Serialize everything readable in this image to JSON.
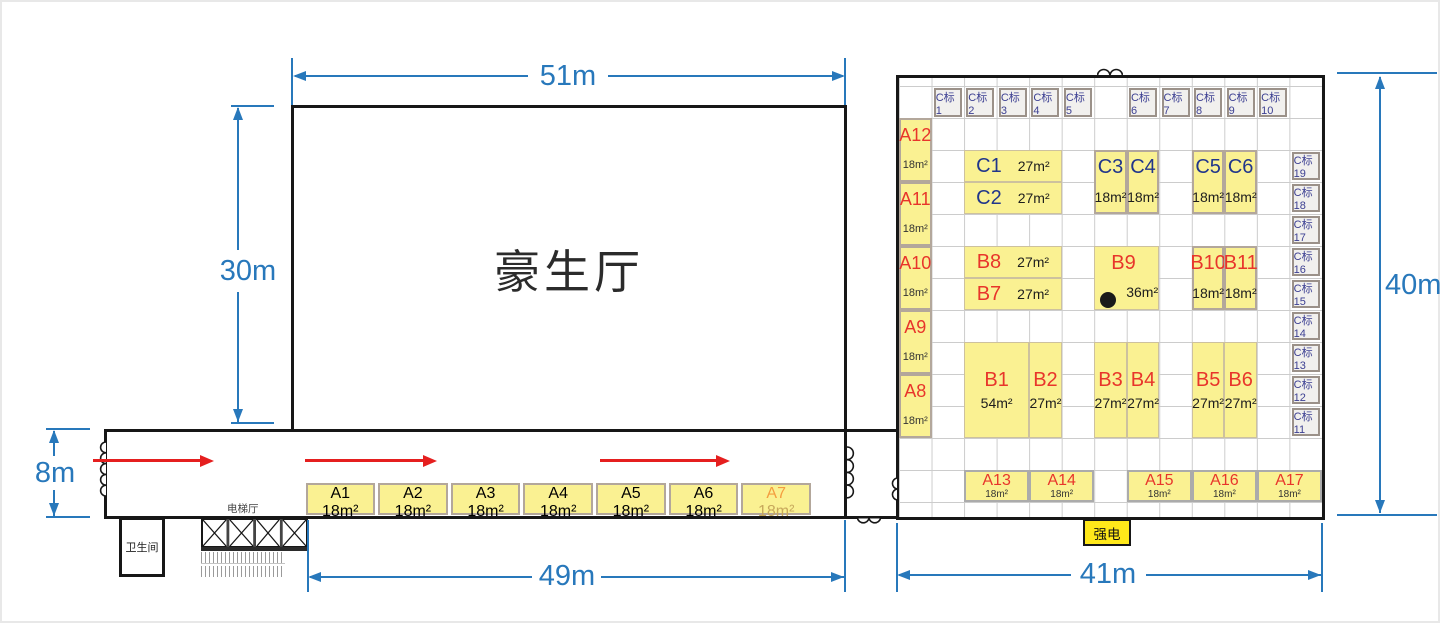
{
  "hall": {
    "name": "豪生厅"
  },
  "labels": {
    "restroom": "卫生间",
    "elevator_hall": "电梯厅",
    "power": "强电"
  },
  "dimensions": {
    "hall_width": "51m",
    "hall_height": "30m",
    "corridor_height": "8m",
    "corridor_width": "49m",
    "right_width": "41m",
    "right_height": "40m"
  },
  "colors": {
    "dimension_blue": "#2878BB",
    "arrow_red": "#E51F1F",
    "booth_yellow": "#FAF192",
    "booth_label_red": "#E8352B",
    "booth_label_blue": "#21368B",
    "stand_gray": "#F1F0EE",
    "stand_text": "#3C3F92",
    "power_yellow": "#FFE81A",
    "muted_orange": "#F49D3F",
    "wall_black": "#171717"
  },
  "corridor": {
    "booths": [
      {
        "id": "A1",
        "label": "A1",
        "area": "18m²"
      },
      {
        "id": "A2",
        "label": "A2",
        "area": "18m²"
      },
      {
        "id": "A3",
        "label": "A3",
        "area": "18m²"
      },
      {
        "id": "A4",
        "label": "A4",
        "area": "18m²"
      },
      {
        "id": "A5",
        "label": "A5",
        "area": "18m²"
      },
      {
        "id": "A6",
        "label": "A6",
        "area": "18m²"
      },
      {
        "id": "A7",
        "label": "A7",
        "area": "18m²",
        "muted": true
      }
    ]
  },
  "right_building": {
    "booths": [
      {
        "id": "Cstand1",
        "label": "C标1",
        "c": 2,
        "r": 1,
        "cls": "stand"
      },
      {
        "id": "Cstand2",
        "label": "C标2",
        "c": 3,
        "r": 1,
        "cls": "stand"
      },
      {
        "id": "Cstand3",
        "label": "C标3",
        "c": 4,
        "r": 1,
        "cls": "stand"
      },
      {
        "id": "Cstand4",
        "label": "C标4",
        "c": 5,
        "r": 1,
        "cls": "stand"
      },
      {
        "id": "Cstand5",
        "label": "C标5",
        "c": 6,
        "r": 1,
        "cls": "stand"
      },
      {
        "id": "Cstand6",
        "label": "C标6",
        "c": 8,
        "r": 1,
        "cls": "stand"
      },
      {
        "id": "Cstand7",
        "label": "C标7",
        "c": 9,
        "r": 1,
        "cls": "stand"
      },
      {
        "id": "Cstand8",
        "label": "C标8",
        "c": 10,
        "r": 1,
        "cls": "stand"
      },
      {
        "id": "Cstand9",
        "label": "C标9",
        "c": 11,
        "r": 1,
        "cls": "stand"
      },
      {
        "id": "Cstand10",
        "label": "C标10",
        "c": 12,
        "r": 1,
        "cls": "stand"
      },
      {
        "id": "Cstand19",
        "label": "C标19",
        "c": 13,
        "r": 3,
        "cls": "stand"
      },
      {
        "id": "Cstand18",
        "label": "C标18",
        "c": 13,
        "r": 4,
        "cls": "stand"
      },
      {
        "id": "Cstand17",
        "label": "C标17",
        "c": 13,
        "r": 5,
        "cls": "stand"
      },
      {
        "id": "Cstand16",
        "label": "C标16",
        "c": 13,
        "r": 6,
        "cls": "stand"
      },
      {
        "id": "Cstand15",
        "label": "C标15",
        "c": 13,
        "r": 7,
        "cls": "stand"
      },
      {
        "id": "Cstand14",
        "label": "C标14",
        "c": 13,
        "r": 8,
        "cls": "stand"
      },
      {
        "id": "Cstand13",
        "label": "C标13",
        "c": 13,
        "r": 9,
        "cls": "stand"
      },
      {
        "id": "Cstand12",
        "label": "C标12",
        "c": 13,
        "r": 10,
        "cls": "stand"
      },
      {
        "id": "Cstand11",
        "label": "C标11",
        "c": 13,
        "r": 11,
        "cls": "stand"
      },
      {
        "id": "A12",
        "label": "A12",
        "area": "18m²",
        "c": 1,
        "r": 2,
        "h": 2,
        "cls": "stack",
        "color": "a"
      },
      {
        "id": "A11",
        "label": "A11",
        "area": "18m²",
        "c": 1,
        "r": 4,
        "h": 2,
        "cls": "stack",
        "color": "a"
      },
      {
        "id": "A10",
        "label": "A10",
        "area": "18m²",
        "c": 1,
        "r": 6,
        "h": 2,
        "cls": "stack",
        "color": "a"
      },
      {
        "id": "A9",
        "label": "A9",
        "area": "18m²",
        "c": 1,
        "r": 8,
        "h": 2,
        "cls": "stack",
        "color": "a"
      },
      {
        "id": "A8",
        "label": "A8",
        "area": "18m²",
        "c": 1,
        "r": 10,
        "h": 2,
        "cls": "stack",
        "color": "a"
      },
      {
        "id": "C1",
        "label": "C1",
        "area": "27m²",
        "c": 3,
        "r": 3,
        "w": 3,
        "cls": "wide",
        "color": "c"
      },
      {
        "id": "C2",
        "label": "C2",
        "area": "27m²",
        "c": 3,
        "r": 4,
        "w": 3,
        "cls": "wide",
        "color": "c"
      },
      {
        "id": "C3",
        "label": "C3",
        "area": "18m²",
        "c": 7,
        "r": 3,
        "h": 2,
        "cls": "stack",
        "color": "c"
      },
      {
        "id": "C4",
        "label": "C4",
        "area": "18m²",
        "c": 8,
        "r": 3,
        "h": 2,
        "cls": "stack",
        "color": "c"
      },
      {
        "id": "C5",
        "label": "C5",
        "area": "18m²",
        "c": 10,
        "r": 3,
        "h": 2,
        "cls": "stack",
        "color": "c"
      },
      {
        "id": "C6",
        "label": "C6",
        "area": "18m²",
        "c": 11,
        "r": 3,
        "h": 2,
        "cls": "stack",
        "color": "c"
      },
      {
        "id": "B8",
        "label": "B8",
        "area": "27m²",
        "c": 3,
        "r": 6,
        "w": 3,
        "cls": "wide",
        "color": "b"
      },
      {
        "id": "B7",
        "label": "B7",
        "area": "27m²",
        "c": 3,
        "r": 7,
        "w": 3,
        "cls": "wide",
        "color": "b"
      },
      {
        "id": "B9",
        "label": "B9",
        "area": "36m²",
        "c": 7,
        "r": 6,
        "w": 2,
        "h": 2,
        "cls": "bnine",
        "color": "b"
      },
      {
        "id": "B10",
        "label": "B10",
        "area": "18m²",
        "c": 10,
        "r": 6,
        "h": 2,
        "cls": "stack",
        "color": "b"
      },
      {
        "id": "B11",
        "label": "B11",
        "area": "18m²",
        "c": 11,
        "r": 6,
        "h": 2,
        "cls": "stack",
        "color": "b"
      },
      {
        "id": "B1",
        "label": "B1",
        "area": "54m²",
        "c": 3,
        "r": 9,
        "w": 2,
        "h": 3,
        "cls": "center",
        "color": "b"
      },
      {
        "id": "B2",
        "label": "B2",
        "area": "27m²",
        "c": 5,
        "r": 9,
        "h": 3,
        "cls": "center",
        "color": "b"
      },
      {
        "id": "B3",
        "label": "B3",
        "area": "27m²",
        "c": 7,
        "r": 9,
        "h": 3,
        "cls": "center",
        "color": "b"
      },
      {
        "id": "B4",
        "label": "B4",
        "area": "27m²",
        "c": 8,
        "r": 9,
        "h": 3,
        "cls": "center",
        "color": "b"
      },
      {
        "id": "B5",
        "label": "B5",
        "area": "27m²",
        "c": 10,
        "r": 9,
        "h": 3,
        "cls": "center",
        "color": "b"
      },
      {
        "id": "B6",
        "label": "B6",
        "area": "27m²",
        "c": 11,
        "r": 9,
        "h": 3,
        "cls": "center",
        "color": "b"
      },
      {
        "id": "A13",
        "label": "A13",
        "area": "18m²",
        "c": 3,
        "r": 13,
        "w": 2,
        "cls": "tight",
        "color": "a"
      },
      {
        "id": "A14",
        "label": "A14",
        "area": "18m²",
        "c": 5,
        "r": 13,
        "w": 2,
        "cls": "tight",
        "color": "a"
      },
      {
        "id": "A15",
        "label": "A15",
        "area": "18m²",
        "c": 8,
        "r": 13,
        "w": 2,
        "cls": "tight",
        "color": "a"
      },
      {
        "id": "A16",
        "label": "A16",
        "area": "18m²",
        "c": 10,
        "r": 13,
        "w": 2,
        "cls": "tight",
        "color": "a"
      },
      {
        "id": "A17",
        "label": "A17",
        "area": "18m²",
        "c": 12,
        "r": 13,
        "w": 2,
        "cls": "tight",
        "color": "a"
      }
    ]
  }
}
